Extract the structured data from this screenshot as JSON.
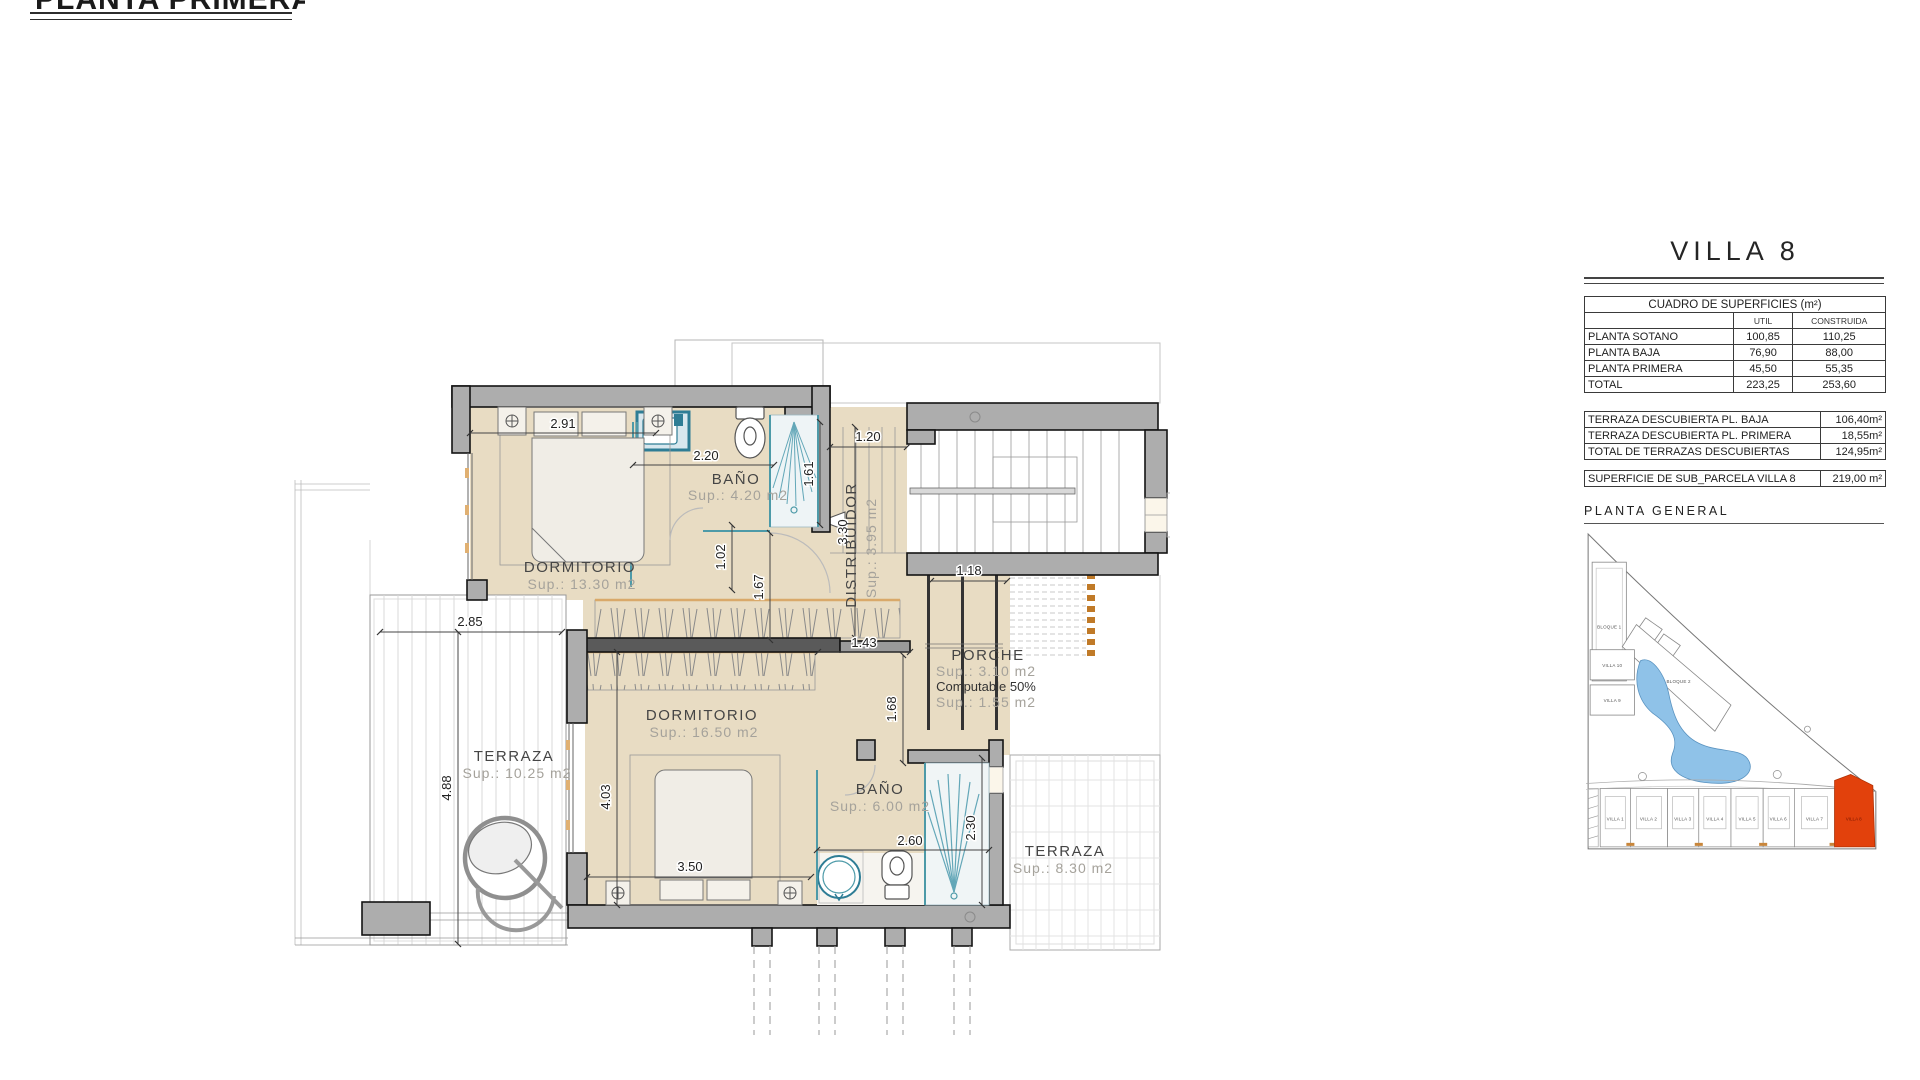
{
  "page": {
    "title": "PLANTA PRIMERA"
  },
  "villa_panel": {
    "title": "VILLA 8",
    "surfaces": {
      "title": "CUADRO DE SUPERFICIES (m²)",
      "col_util": "UTIL",
      "col_construida": "CONSTRUIDA",
      "rows": [
        {
          "label": "PLANTA SOTANO",
          "util": "100,85",
          "construida": "110,25"
        },
        {
          "label": "PLANTA BAJA",
          "util": "76,90",
          "construida": "88,00"
        },
        {
          "label": "PLANTA PRIMERA",
          "util": "45,50",
          "construida": "55,35"
        },
        {
          "label": "TOTAL",
          "util": "223,25",
          "construida": "253,60"
        }
      ]
    },
    "terraces": [
      {
        "label": "TERRAZA DESCUBIERTA PL. BAJA",
        "value": "106,40m²"
      },
      {
        "label": "TERRAZA DESCUBIERTA PL. PRIMERA",
        "value": "18,55m²"
      },
      {
        "label": "TOTAL DE TERRAZAS DESCUBIERTAS",
        "value": "124,95m²"
      }
    ],
    "parcel": {
      "label": "SUPERFICIE DE SUB_PARCELA VILLA 8",
      "value": "219,00 m²"
    },
    "site": {
      "title": "PLANTA GENERAL",
      "bloque1": "BLOQUE 1",
      "bloque2": "BLOQUE 2",
      "villa10": "VILLA 10",
      "villa9": "VILLA 9",
      "villas": [
        "VILLA 1",
        "VILLA 2",
        "VILLA 3",
        "VILLA 4",
        "VILLA 5",
        "VILLA 6",
        "VILLA 7",
        "VILLA 8"
      ],
      "highlight_color": "#e2410c",
      "water_color": "#8fc2e8"
    }
  },
  "floor_plan": {
    "rooms": {
      "dormitorio1": {
        "name": "DORMITORIO",
        "sup": "Sup.: 13.30  m2"
      },
      "bano1": {
        "name": "BAÑO",
        "sup": "Sup.: 4.20   m2"
      },
      "distribuidor": {
        "name": "DISTRIBUIDOR",
        "sup": "Sup.: 3.95  m2"
      },
      "porche": {
        "name": "PORCHE",
        "sup": "Sup.: 3.10    m2",
        "computable": "Computable 50%",
        "sup2": "Sup.: 1.55    m2"
      },
      "dormitorio2": {
        "name": "DORMITORIO",
        "sup": "Sup.: 16.50  m2"
      },
      "bano2": {
        "name": "BAÑO",
        "sup": "Sup.: 6.00   m2"
      },
      "terraza_izq": {
        "name": "TERRAZA",
        "sup": "Sup.: 10.25  m2"
      },
      "terraza_der": {
        "name": "TERRAZA",
        "sup": "Sup.: 8.30   m2"
      }
    },
    "dimensions": {
      "dorm1_top": "2.91",
      "bano1_w": "2.20",
      "shower1_h": "1.61",
      "distrib_w": "1.20",
      "distrib_l": "3.30",
      "gap1": "1.02",
      "gap2": "1.67",
      "terr1_w": "2.85",
      "terr1_h": "4.88",
      "closet": "1.43",
      "porche_w": "1.18",
      "porche_h": "1.68",
      "dorm2_h": "4.03",
      "dorm2_w": "3.50",
      "bano2_w": "2.60",
      "bano2_h": "2.30"
    },
    "wall_color": "#adadad",
    "floor_color": "#e8dcc3",
    "fixture_color": "#3c8ea1"
  }
}
